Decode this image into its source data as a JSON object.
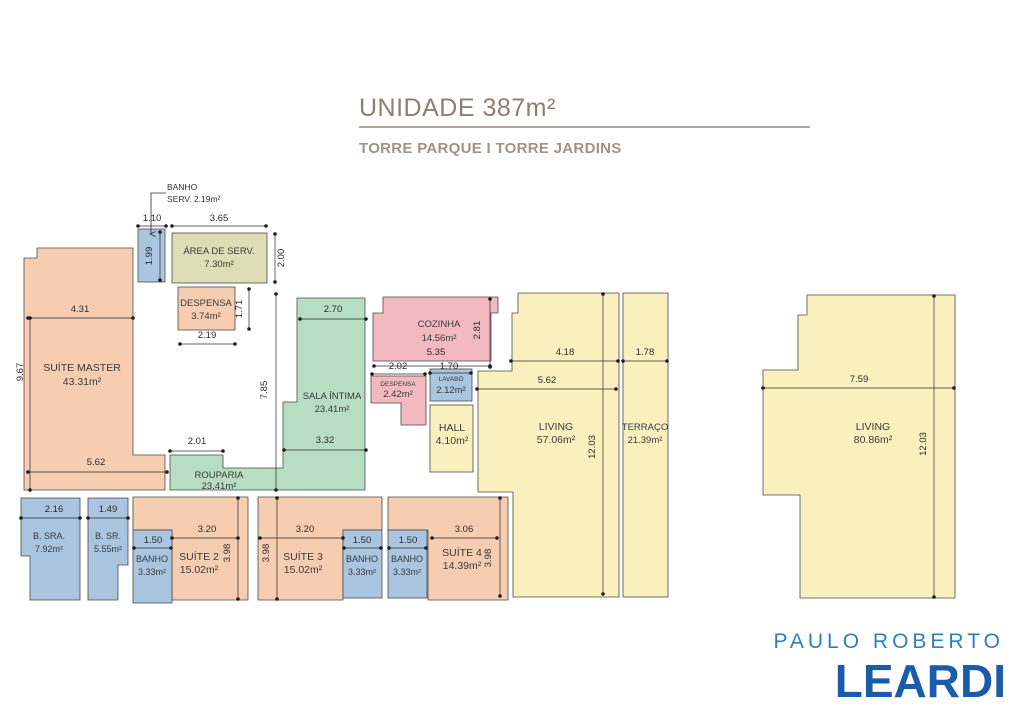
{
  "header": {
    "title": "UNIDADE 387m²",
    "subtitle": "TORRE PARQUE I TORRE JARDINS"
  },
  "logo": {
    "top": "PAULO ROBERTO",
    "main": "LEARDI"
  },
  "callout": {
    "line1": "BANHO",
    "line2": "SERV.  2.19m²"
  },
  "colors": {
    "salmon": "#F7CDB2",
    "green": "#B7DDC3",
    "blue": "#A9C5DF",
    "yellow": "#FAF0BE",
    "pink": "#F3B9C1",
    "beige": "#DEDDB5",
    "title-color": "#8B7F73",
    "subtitle-color": "#A19284",
    "rule-color": "#7D7266",
    "logo-light": "#2E7EC3",
    "logo-dark": "#1A5BAA"
  },
  "rooms": [
    {
      "name": "SUÍTE MASTER",
      "area": "43.31m²"
    },
    {
      "name": "ÁREA DE SERV.",
      "area": "7.30m²"
    },
    {
      "name": "DESPENSA",
      "area": "3.74m²"
    },
    {
      "name": "SALA ÍNTIMA",
      "area": "23.41m²"
    },
    {
      "name": "ROUPARIA",
      "area": "23.41m²"
    },
    {
      "name": "COZINHA",
      "area": "14.56m²"
    },
    {
      "name": "DESPENSA",
      "area": "2.42m²"
    },
    {
      "name": "LAVABO",
      "area": "2.12m²"
    },
    {
      "name": "HALL",
      "area": "4.10m²"
    },
    {
      "name": "LIVING",
      "area": "57.06m²"
    },
    {
      "name": "TERRAÇO",
      "area": "21.39m²"
    },
    {
      "name": "LIVING",
      "area": "80.86m²"
    },
    {
      "name": "B. SRA.",
      "area": "7.92m²"
    },
    {
      "name": "B. SR.",
      "area": "5.55m²"
    },
    {
      "name": "BANHO",
      "area": "3.33m²"
    },
    {
      "name": "SUÍTE 2",
      "area": "15.02m²"
    },
    {
      "name": "SUÍTE 3",
      "area": "15.02m²"
    },
    {
      "name": "BANHO",
      "area": "3.33m²"
    },
    {
      "name": "BANHO",
      "area": "3.33m²"
    },
    {
      "name": "SUÍTE 4",
      "area": "14.39m²"
    }
  ],
  "dims": [
    "1.10",
    "3.65",
    "1.99",
    "2.00",
    "1.71",
    "2.19",
    "4.31",
    "9.67",
    "5.62",
    "2.01",
    "7.85",
    "2.70",
    "3.32",
    "5.35",
    "2.81",
    "2.02",
    "1.70",
    "4.18",
    "1.78",
    "5.62",
    "12.03",
    "7.59",
    "12.03",
    "2.16",
    "1.49",
    "1.50",
    "3.20",
    "3.98",
    "3.98",
    "3.20",
    "1.50",
    "1.50",
    "3.06",
    "3.98"
  ]
}
